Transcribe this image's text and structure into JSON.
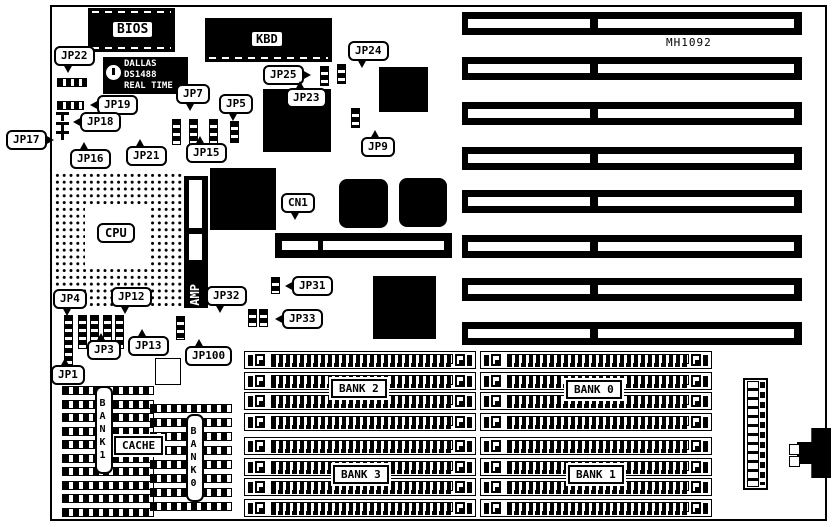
{
  "diagram": {
    "board_model": "MH1092",
    "colors": {
      "ink": "#000000",
      "paper": "#ffffff"
    }
  },
  "static": {
    "mh1092": "MH1092",
    "bios": "BIOS",
    "kbd": "KBD",
    "cpu": "CPU",
    "amp": "AMP",
    "cache": "CACHE",
    "bank1_vertical": "BANK1",
    "bank0_vertical": "BANK0",
    "rtc_line1": "DALLAS",
    "rtc_line2": "DS1488",
    "rtc_line3": "REAL TIME"
  },
  "callouts": [
    {
      "label": "JP22",
      "x": 54,
      "y": 46,
      "tail": "down"
    },
    {
      "label": "JP19",
      "x": 97,
      "y": 95,
      "tail": "left"
    },
    {
      "label": "JP18",
      "x": 80,
      "y": 112,
      "tail": "left"
    },
    {
      "label": "JP17",
      "x": 6,
      "y": 130,
      "tail": "right"
    },
    {
      "label": "JP16",
      "x": 70,
      "y": 149,
      "tail": "up"
    },
    {
      "label": "JP21",
      "x": 126,
      "y": 146,
      "tail": "up"
    },
    {
      "label": "JP15",
      "x": 186,
      "y": 143,
      "tail": "up"
    },
    {
      "label": "JP7",
      "x": 176,
      "y": 84,
      "tail": "down"
    },
    {
      "label": "JP5",
      "x": 219,
      "y": 94,
      "tail": "down"
    },
    {
      "label": "JP25",
      "x": 263,
      "y": 65,
      "tail": "right"
    },
    {
      "label": "JP24",
      "x": 348,
      "y": 41,
      "tail": "down"
    },
    {
      "label": "JP23",
      "x": 286,
      "y": 88,
      "tail": "up"
    },
    {
      "label": "JP9",
      "x": 361,
      "y": 137,
      "tail": "up"
    },
    {
      "label": "CN1",
      "x": 281,
      "y": 193,
      "tail": "down"
    },
    {
      "label": "JP31",
      "x": 292,
      "y": 276,
      "tail": "left"
    },
    {
      "label": "JP32",
      "x": 206,
      "y": 286,
      "tail": "down"
    },
    {
      "label": "JP33",
      "x": 282,
      "y": 309,
      "tail": "left"
    },
    {
      "label": "JP4",
      "x": 53,
      "y": 289,
      "tail": "down"
    },
    {
      "label": "JP12",
      "x": 111,
      "y": 287,
      "tail": "down"
    },
    {
      "label": "JP3",
      "x": 87,
      "y": 340,
      "tail": "up"
    },
    {
      "label": "JP13",
      "x": 128,
      "y": 336,
      "tail": "up"
    },
    {
      "label": "JP100",
      "x": 185,
      "y": 346,
      "tail": "up"
    },
    {
      "label": "JP1",
      "x": 51,
      "y": 365,
      "tail": "up"
    }
  ],
  "bank_labels": [
    {
      "label": "BANK 2",
      "x": 331,
      "y": 379
    },
    {
      "label": "BANK 3",
      "x": 333,
      "y": 465
    },
    {
      "label": "BANK 0",
      "x": 566,
      "y": 380
    },
    {
      "label": "BANK 1",
      "x": 568,
      "y": 465
    }
  ],
  "jumpers": [
    {
      "type": "h",
      "x": 57,
      "y": 78,
      "w": 30,
      "h": 9
    },
    {
      "type": "h",
      "x": 57,
      "y": 101,
      "w": 27,
      "h": 9
    },
    {
      "type": "t",
      "x": 56,
      "y": 112
    },
    {
      "type": "t",
      "x": 56,
      "y": 122
    },
    {
      "type": "t",
      "x": 56,
      "y": 131
    },
    {
      "type": "v",
      "x": 172,
      "y": 119,
      "h": 26
    },
    {
      "type": "v",
      "x": 189,
      "y": 119,
      "h": 26
    },
    {
      "type": "v",
      "x": 209,
      "y": 119,
      "h": 26
    },
    {
      "type": "v",
      "x": 230,
      "y": 121,
      "h": 22
    },
    {
      "type": "v",
      "x": 320,
      "y": 66,
      "h": 20
    },
    {
      "type": "v",
      "x": 337,
      "y": 64,
      "h": 20
    },
    {
      "type": "v",
      "x": 351,
      "y": 108,
      "h": 20
    },
    {
      "type": "v",
      "x": 271,
      "y": 277,
      "h": 17
    },
    {
      "type": "v",
      "x": 248,
      "y": 309,
      "h": 18
    },
    {
      "type": "v",
      "x": 259,
      "y": 309,
      "h": 18
    },
    {
      "type": "v",
      "x": 64,
      "y": 315,
      "h": 50
    },
    {
      "type": "v",
      "x": 78,
      "y": 315,
      "h": 34
    },
    {
      "type": "v",
      "x": 90,
      "y": 315,
      "h": 34
    },
    {
      "type": "v",
      "x": 103,
      "y": 315,
      "h": 34
    },
    {
      "type": "v",
      "x": 115,
      "y": 315,
      "h": 34
    },
    {
      "type": "v",
      "x": 176,
      "y": 316,
      "h": 24
    }
  ],
  "misc_chips": [
    {
      "type": "qfp",
      "name": "qfp-chip-1",
      "x": 210,
      "y": 168,
      "w": 66,
      "h": 62
    },
    {
      "type": "qfp",
      "name": "qfp-chip-2",
      "x": 263,
      "y": 89,
      "w": 68,
      "h": 63
    },
    {
      "type": "solid",
      "name": "solid-chip-1",
      "x": 379,
      "y": 67,
      "w": 49,
      "h": 45
    },
    {
      "type": "plcc",
      "name": "plcc-chip-1",
      "x": 339,
      "y": 179,
      "w": 49,
      "h": 49
    },
    {
      "type": "plcc",
      "name": "plcc-chip-2",
      "x": 399,
      "y": 178,
      "w": 48,
      "h": 49
    },
    {
      "type": "qfp",
      "name": "qfp-chip-3",
      "x": 373,
      "y": 276,
      "w": 63,
      "h": 63
    },
    {
      "type": "outline",
      "name": "empty-socket",
      "x": 155,
      "y": 358,
      "w": 26,
      "h": 27
    }
  ],
  "isa": {
    "count": 8,
    "x": 462,
    "w": 340,
    "h": 23,
    "y_list": [
      12,
      57,
      102,
      147,
      190,
      235,
      278,
      322
    ],
    "inner_left": {
      "x": 6,
      "w": 122
    },
    "inner_right": {
      "x": 136,
      "w": 196
    }
  },
  "simm": {
    "slot_w": 232,
    "slot_h": 18,
    "pitch": 20.5,
    "slots_per_group": 4,
    "groups": [
      {
        "name": "bank2",
        "x": 244,
        "y": 351
      },
      {
        "name": "bank3",
        "x": 244,
        "y": 437
      },
      {
        "name": "bank0",
        "x": 480,
        "y": 351
      },
      {
        "name": "bank1",
        "x": 480,
        "y": 437
      }
    ]
  },
  "cache_groups": [
    {
      "name": "cache-bank1",
      "x": 62,
      "y": 386,
      "w": 92,
      "rows": 10,
      "pitch": 13.5
    },
    {
      "name": "cache-bank0",
      "x": 150,
      "y": 404,
      "w": 82,
      "rows": 8,
      "pitch": 14
    }
  ],
  "cn1_inner": [
    {
      "x": 7,
      "w": 36
    },
    {
      "x": 48,
      "w": 121
    }
  ],
  "amp_slots": [
    {
      "y": 4,
      "h": 48
    },
    {
      "y": 58,
      "h": 26
    }
  ],
  "din_pins": [
    {
      "x": 789,
      "y": 444
    },
    {
      "x": 789,
      "y": 456
    }
  ]
}
